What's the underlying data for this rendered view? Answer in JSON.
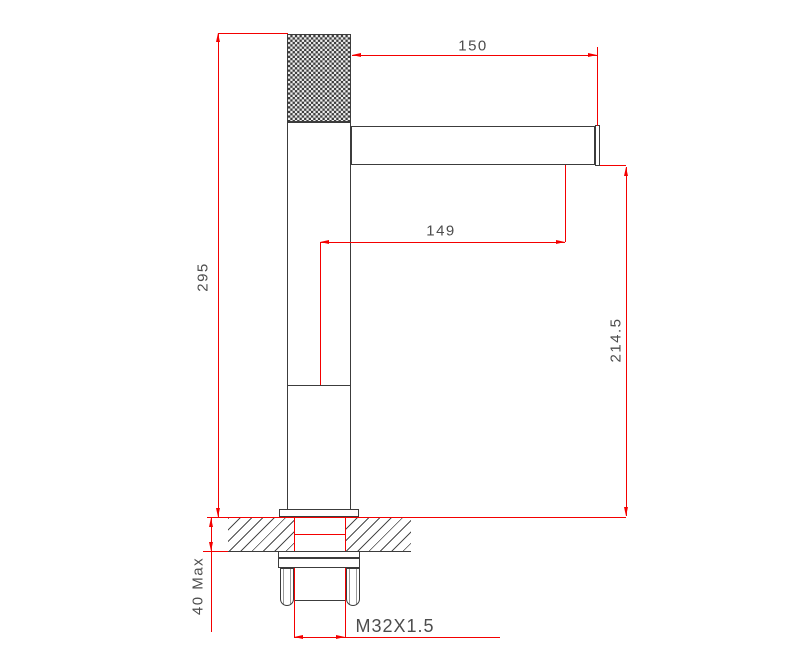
{
  "colors": {
    "outline": "#3c3c3c",
    "dimension": "#f40000",
    "label": "#4d4d4d",
    "paper": "#ffffff"
  },
  "dimensions": {
    "total_height": "295",
    "spout_reach": "150",
    "spout_reach_to_center": "149",
    "height_to_spout": "214.5",
    "mount_thickness": "40 Max",
    "thread": "M32X1.5"
  }
}
